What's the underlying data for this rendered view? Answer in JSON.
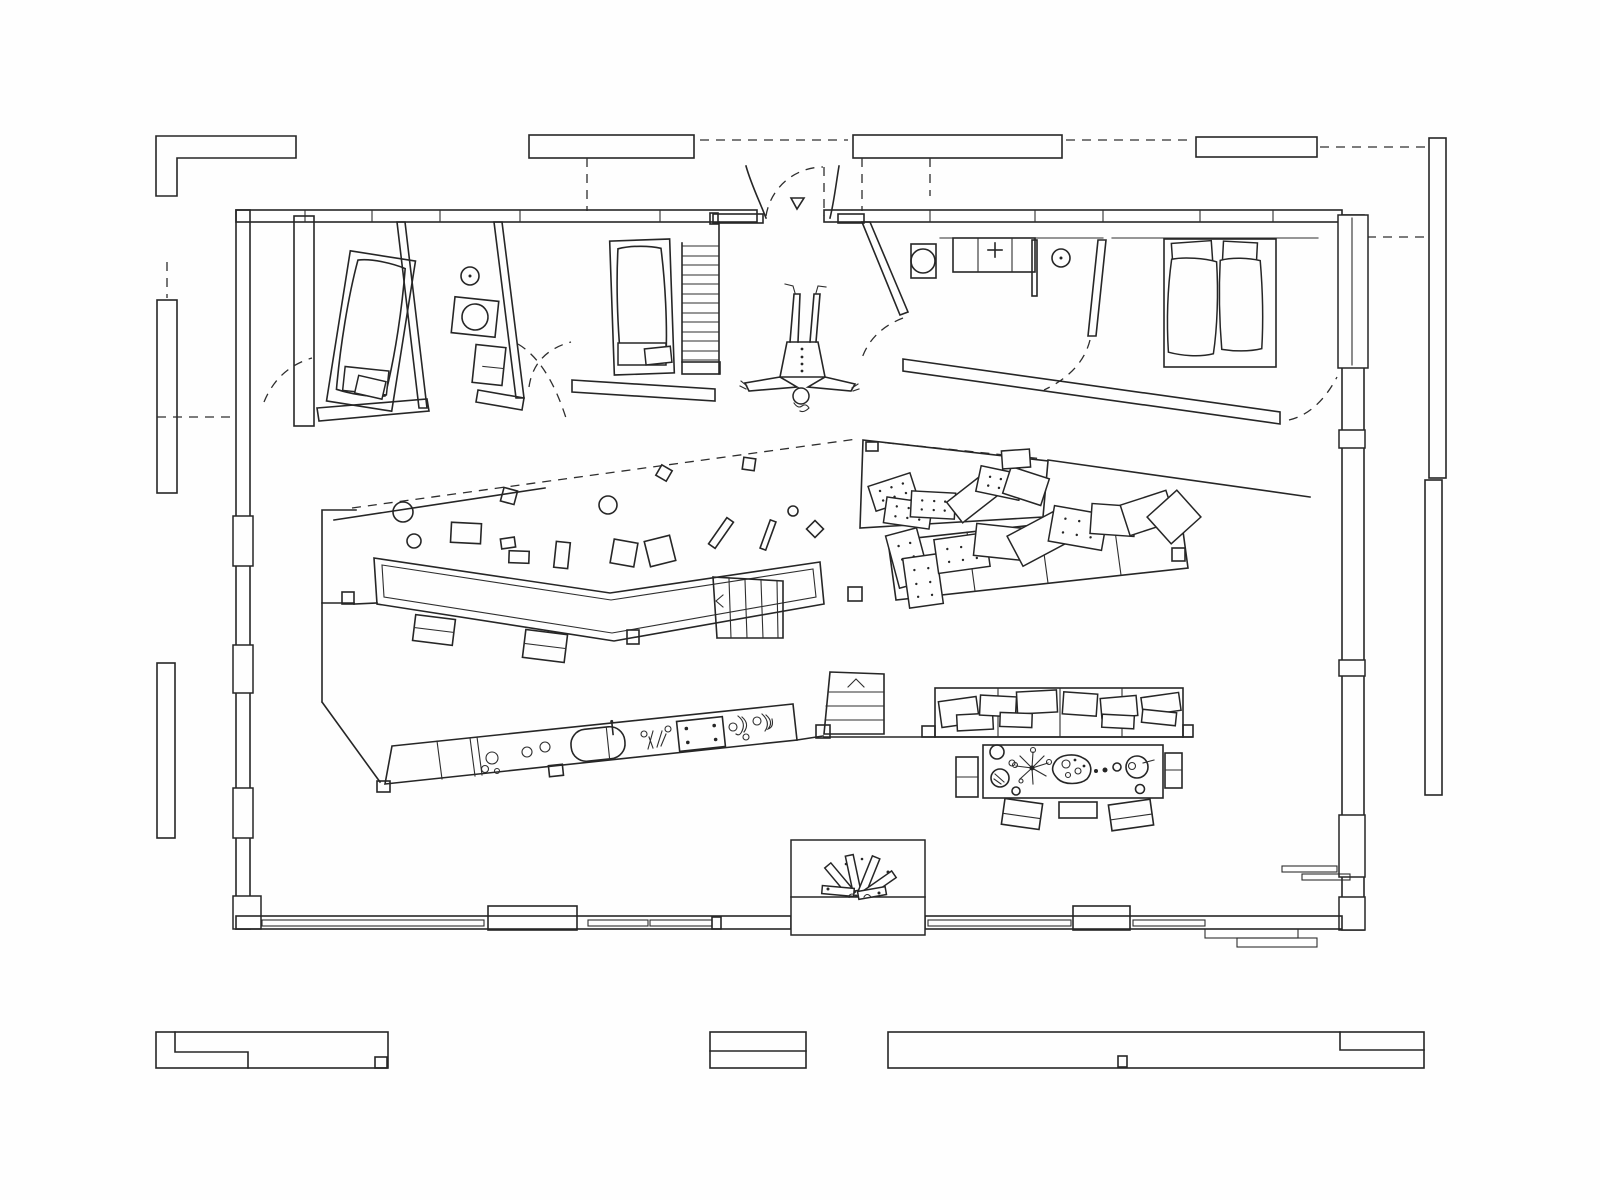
{
  "drawing": {
    "kind": "hand-drawn architectural floor plan (single-storey butterfly-plan house)",
    "colors": {
      "paper": "#fefefe",
      "ink": "#262626"
    },
    "symbols": {
      "entry_marker": "down-pointing open triangle at main entrance",
      "door_swings": "dashed quarter-circle arcs",
      "roof_line": "long dashed diagonal across central hall",
      "figure": "person doing a handstand in the entry hall",
      "stair_arrows": "chevron direction arrows on both stairs"
    },
    "rooms": [
      {
        "name": "bedroom-1",
        "furniture": [
          "single-bed"
        ]
      },
      {
        "name": "bathroom-1",
        "furniture": [
          "ceiling-lamp",
          "toilet",
          "washbasin"
        ]
      },
      {
        "name": "bedroom-2",
        "furniture": [
          "single-bed",
          "ladder-stair"
        ]
      },
      {
        "name": "entry-hall",
        "furniture": [
          "handstand-figure",
          "entrance-triangle"
        ]
      },
      {
        "name": "wc-kitchenette",
        "furniture": [
          "toilet",
          "counter-with-faucet",
          "ceiling-lamp"
        ]
      },
      {
        "name": "bedroom-3",
        "furniture": [
          "double-bed"
        ]
      },
      {
        "name": "central-hall",
        "furniture": [
          "long-desk",
          "benches",
          "scattered-toys",
          "stair-down"
        ]
      },
      {
        "name": "lounge-pit",
        "furniture": [
          "loose-cushions"
        ]
      },
      {
        "name": "sofa-bench-band",
        "furniture": [
          "cushion-row"
        ]
      },
      {
        "name": "living-dining",
        "furniture": [
          "kitchen-counter",
          "sink",
          "cooktop",
          "stair-block",
          "sofa-row",
          "dining-table",
          "chairs",
          "fireplace-with-logs"
        ]
      }
    ],
    "exterior": [
      "pergola-strips-top",
      "pergola-strips-sides",
      "garden-walls-bottom",
      "dashed-setout-lines"
    ]
  }
}
